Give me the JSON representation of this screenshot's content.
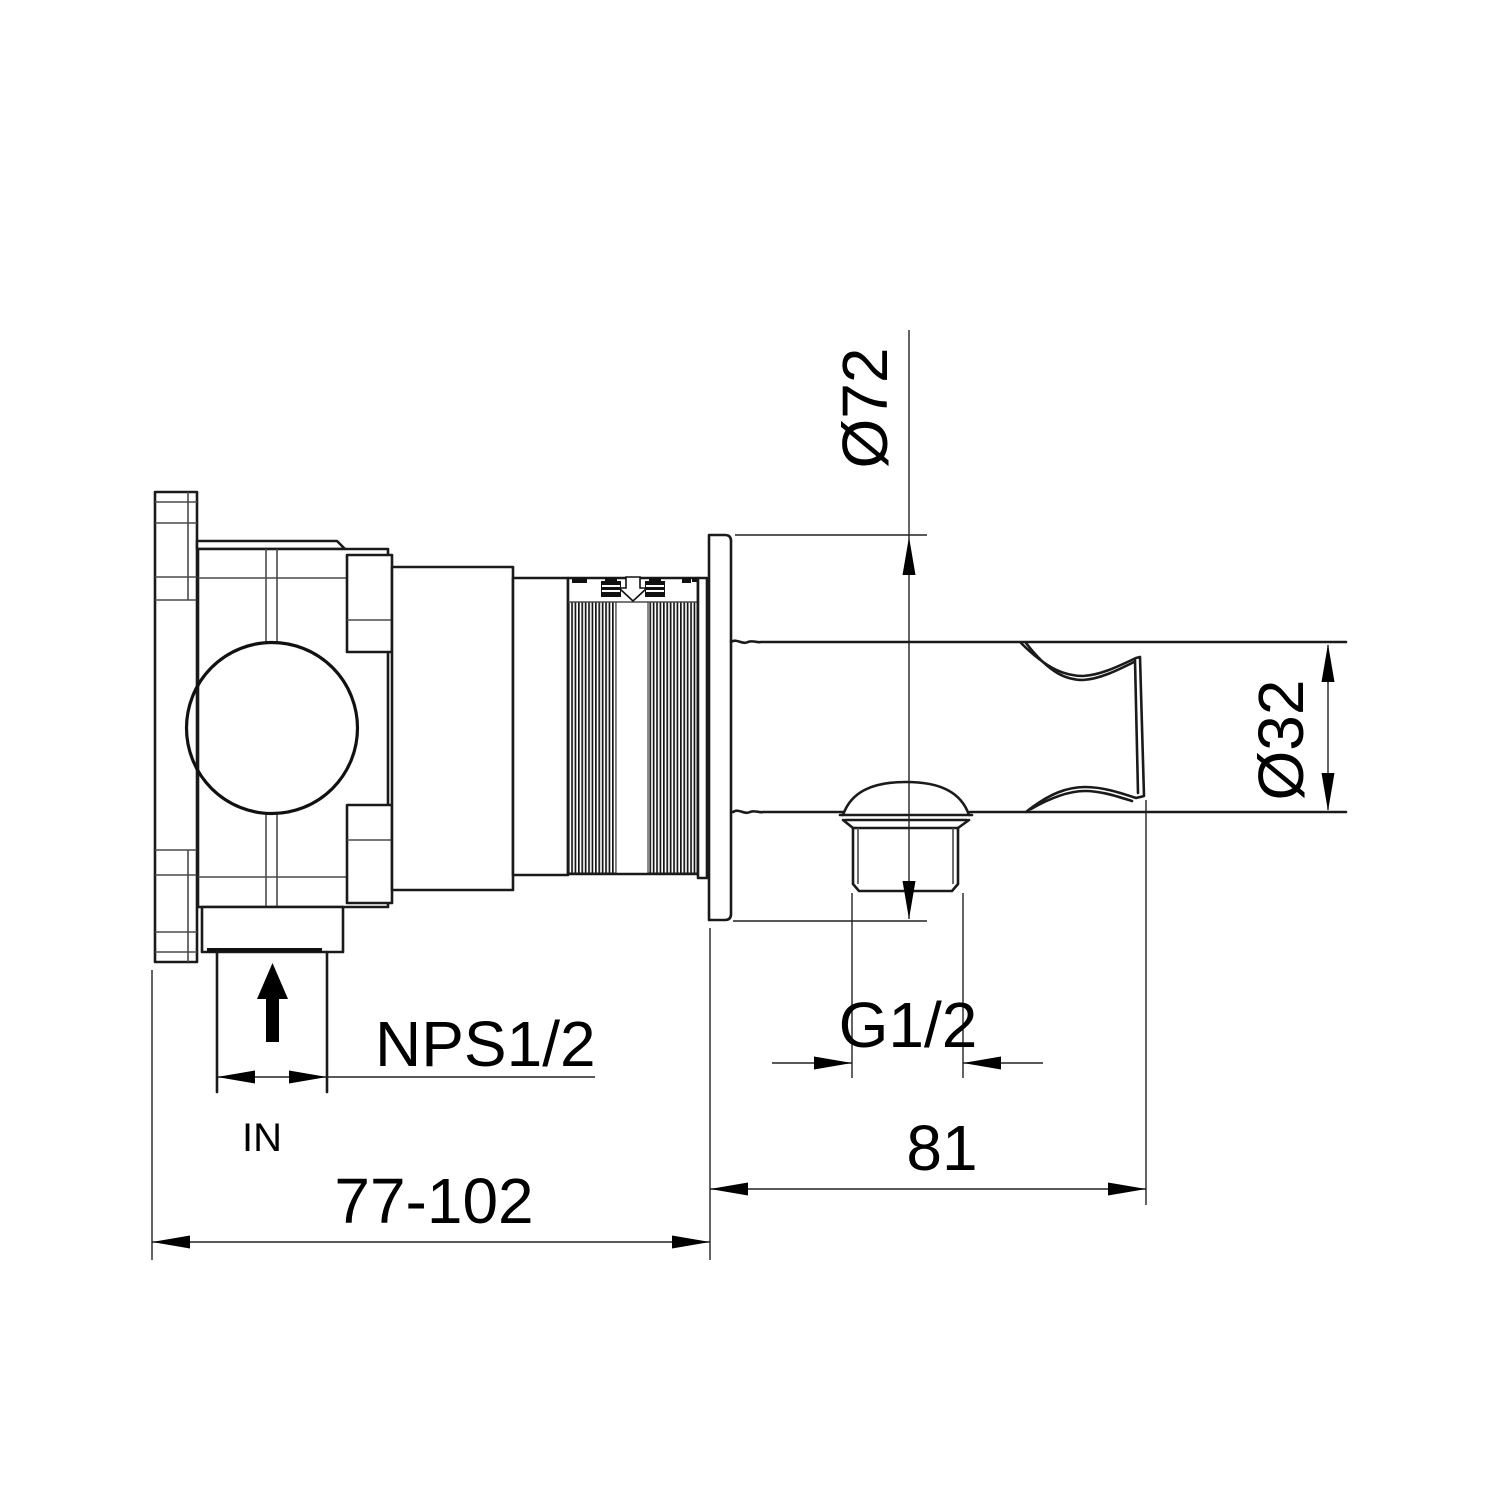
{
  "drawing": {
    "type": "technical-installation-diagram",
    "subject": "concealed shower valve with wall plate, outlet nipple and hand shower holder (side section view)",
    "background_color": "#ffffff",
    "line_color": "#1a1a1a",
    "dimensions": {
      "plate_diameter": {
        "label": "Ø72",
        "value": 72,
        "unit": "mm",
        "orientation": "vertical"
      },
      "holder_diameter": {
        "label": "Ø32",
        "value": 32,
        "unit": "mm",
        "orientation": "vertical"
      },
      "outlet_thread": {
        "label": "G1/2",
        "orientation": "horizontal"
      },
      "wall_to_holder_depth": {
        "label": "81",
        "value": 81,
        "unit": "mm",
        "orientation": "horizontal"
      },
      "inlet_thread": {
        "label": "NPS1/2",
        "orientation": "horizontal"
      },
      "inlet_direction": {
        "label": "IN"
      },
      "installation_depth_range": {
        "label": "77-102",
        "value_min": 77,
        "value_max": 102,
        "unit": "mm",
        "orientation": "horizontal"
      }
    },
    "icons": {
      "inlet_flow_arrow": "up-arrow-icon",
      "cartridge_flow_arrow": "down-arrow-icon"
    }
  }
}
